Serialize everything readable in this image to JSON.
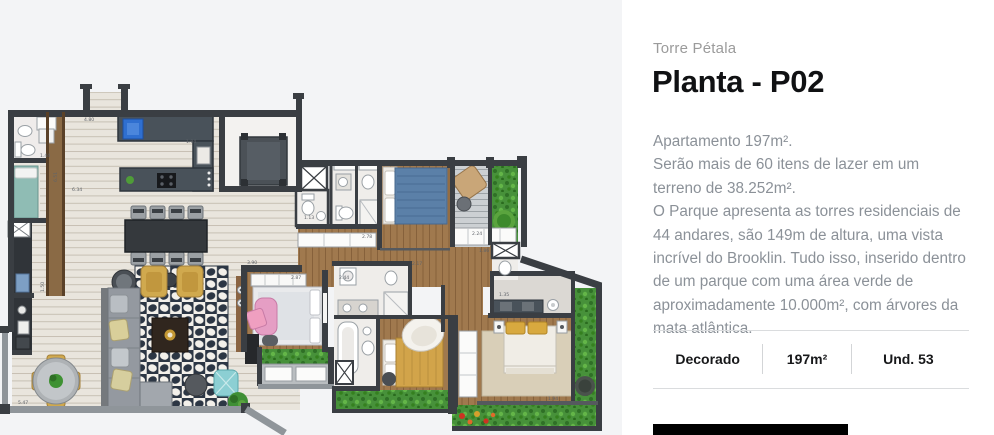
{
  "panel": {
    "eyebrow": "Torre Pétala",
    "title": "Planta - P02",
    "description": [
      "Apartamento 197m².",
      "Serão mais de 60 itens de lazer em um terreno de 38.252m².",
      "O Parque apresenta as torres residenciais de 44 andares, são 149m de altura, uma vista incrível do Brooklin. Tudo isso, inserido dentro de um parque com uma área verde de aproximadamente 10.000m², com árvores da mata atlântica."
    ],
    "specs": [
      {
        "label": "Decorado"
      },
      {
        "label": "197m²"
      },
      {
        "label": "Und. 53"
      }
    ]
  },
  "floorplan": {
    "name": "planta-p02-floor-plan",
    "colors": {
      "wall": "#3a3e43",
      "rail": "#8f959a",
      "floor_tile": "#e9e5dd",
      "wood": "#a0794e",
      "garden": "#47913a",
      "rug_dot": "#2c3644",
      "counter": "#49525a",
      "sink_blue": "#2f6fd0",
      "bed_blue": "#5b80a8",
      "bed_yellow": "#d2a44a",
      "bed_teal": "#8fbcb4",
      "chair_pink": "#e59ec4",
      "accent_cta": "#000000",
      "plan_bg": "#f3f4f6"
    },
    "dimension_labels": [
      {
        "t": "4.80",
        "x": 84,
        "y": 121
      },
      {
        "t": "1.04",
        "x": 186,
        "y": 143
      },
      {
        "t": "6.51",
        "x": 57,
        "y": 182,
        "r": -90
      },
      {
        "t": "1.44",
        "x": 40,
        "y": 157
      },
      {
        "t": "6.34",
        "x": 72,
        "y": 191
      },
      {
        "t": "1.50",
        "x": 44,
        "y": 292,
        "r": -90
      },
      {
        "t": "5.47",
        "x": 18,
        "y": 404
      },
      {
        "t": "3.90",
        "x": 247,
        "y": 264
      },
      {
        "t": "1.13",
        "x": 304,
        "y": 219
      },
      {
        "t": "2.78",
        "x": 362,
        "y": 238
      },
      {
        "t": "2.87",
        "x": 291,
        "y": 279
      },
      {
        "t": "2.44",
        "x": 339,
        "y": 279
      },
      {
        "t": "2.24",
        "x": 472,
        "y": 235
      },
      {
        "t": "1.86",
        "x": 479,
        "y": 252
      },
      {
        "t": "1.35",
        "x": 499,
        "y": 296
      },
      {
        "t": "2.17",
        "x": 412,
        "y": 265
      },
      {
        "t": "1.94",
        "x": 548,
        "y": 400
      }
    ]
  }
}
